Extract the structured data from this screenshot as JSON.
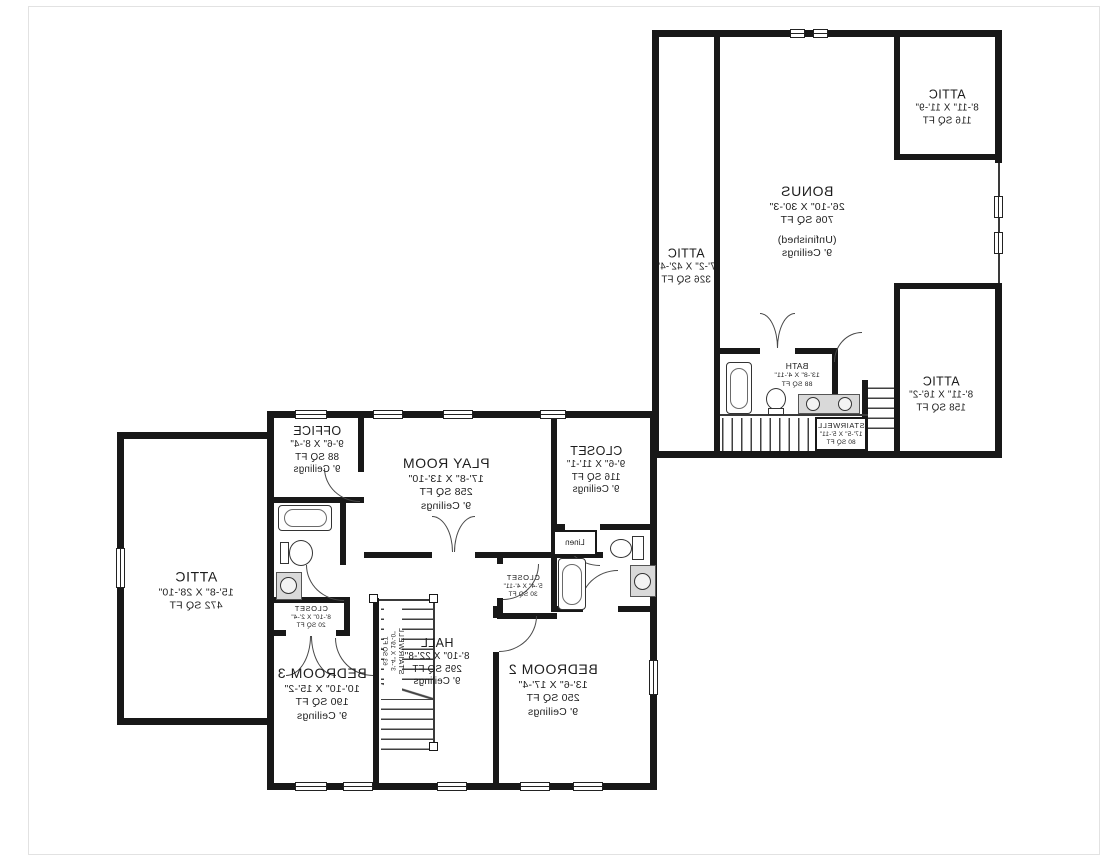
{
  "rooms": {
    "bonus": {
      "name": "BONUS",
      "dims": "26'-10\" X 30'-3\"",
      "area": "706 SQ FT",
      "note": "(Unfinished)",
      "ceilings": "9' Ceilings"
    },
    "attic_left_strip": {
      "name": "ATTIC",
      "dims": "7'-2\" X 42'-4\"",
      "area": "326 SQ FT"
    },
    "attic_top_right": {
      "name": "ATTIC",
      "dims": "8'-11\" X 11'-9\"",
      "area": "116 SQ FT"
    },
    "attic_bottom_right": {
      "name": "ATTIC",
      "dims": "8'-11\" X 16'-2\"",
      "area": "158 SQ FT"
    },
    "bath_upper": {
      "name": "BATH",
      "dims": "13'-8\" X 4'-11\"",
      "area": "88 SQ FT"
    },
    "stairwell_upper": {
      "name": "STAIRWELL",
      "dims": "17'-5\" X 5'-11\"",
      "area": "80 SQ FT"
    },
    "attic_large": {
      "name": "ATTIC",
      "dims": "15'-8\" X 28'-10\"",
      "area": "472 SQ FT"
    },
    "office": {
      "name": "OFFICE",
      "dims": "9'-6\" X 8'-4\"",
      "area": "88 SQ FT",
      "ceilings": "9' Ceilings"
    },
    "play_room": {
      "name": "PLAY ROOM",
      "dims": "17'-8\" X 13'-10\"",
      "area": "258 SQ FT",
      "ceilings": "9' Ceilings"
    },
    "closet_walkin": {
      "name": "CLOSET",
      "dims": "9'-6\" X 11'-1\"",
      "area": "116 SQ FT",
      "ceilings": "9' Ceilings"
    },
    "linen": {
      "name": "Linen"
    },
    "closet_hall": {
      "name": "CLOSET",
      "dims": "8'-10\" X 2'-4\"",
      "area": "20 SQ FT"
    },
    "closet_bedroom2": {
      "name": "CLOSET",
      "dims": "5'-4\" X 4'-11\"",
      "area": "30 SQ FT"
    },
    "hall": {
      "name": "HALL",
      "dims": "8'-10\" X 22'-8\"",
      "area": "295 SQ FT",
      "ceilings": "9' Ceilings"
    },
    "bedroom3": {
      "name": "BEDROOM 3",
      "dims": "10'-10\" X 15'-2\"",
      "area": "190 SQ FT",
      "ceilings": "9' Ceilings"
    },
    "bedroom2": {
      "name": "BEDROOM 2",
      "dims": "13'-6\" X 17'-4\"",
      "area": "250 SQ FT",
      "ceilings": "9' Ceilings"
    },
    "stairwell_lower": {
      "name": "STAIRWELL",
      "dims": "3'-4\" X 19'-0\"",
      "area": "63 SQ FT"
    }
  },
  "colors": {
    "wall": "#181818",
    "text": "#1d1d1d",
    "fixture_fill": "#d9d9d9",
    "background": "#ffffff"
  }
}
